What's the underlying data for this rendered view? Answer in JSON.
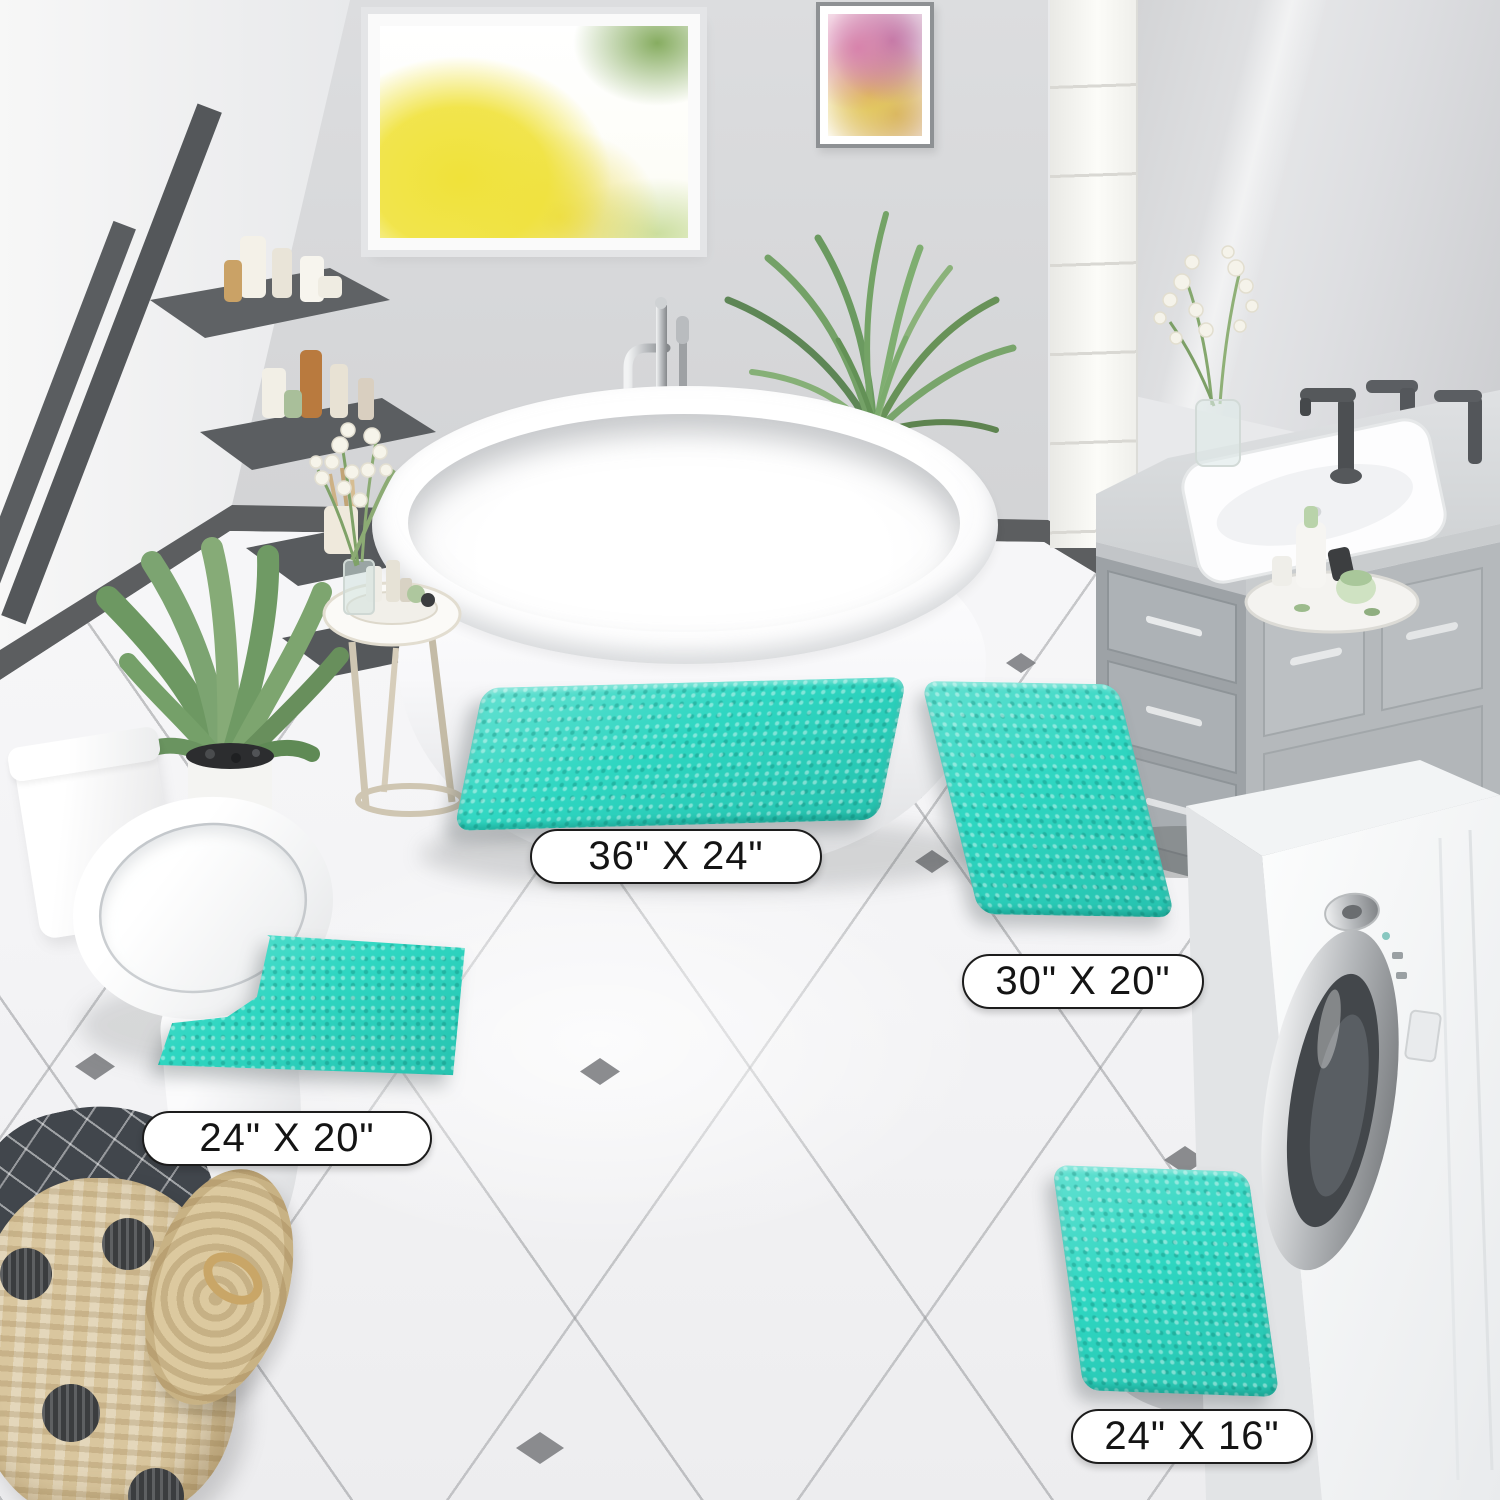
{
  "scene": {
    "type": "bathroom-product-photo",
    "subject": "4-piece turquoise chenille bath rug set shown on bathroom floor",
    "room_objects": [
      "window-with-yellow-trees",
      "wall-art",
      "ladder-shelf",
      "toilet",
      "potted-plant",
      "freestanding-bathtub",
      "tub-faucet",
      "palm-plant",
      "side-table",
      "gladiolus-flowers",
      "double-sink-vanity",
      "mirror",
      "tall-cabinet",
      "washing-machine",
      "wicker-laundry-basket"
    ]
  },
  "rug": {
    "color_name": "turquoise",
    "color_hex": "#2ed6c1"
  },
  "size_labels": [
    {
      "mat": "rectangle-large",
      "text": "36\" X 24\""
    },
    {
      "mat": "rectangle-medium",
      "text": "30\" X 20\""
    },
    {
      "mat": "contour-u-shape",
      "text": "24\" X 20\""
    },
    {
      "mat": "rectangle-small",
      "text": "24\" X 16\""
    }
  ],
  "palette": {
    "back_wall": "#d6d7d9",
    "left_wall": "#f4f4f4",
    "floor": "#f6f6f7",
    "grout": "#c8c9cb",
    "baseboard": "#5c5e60",
    "accent_diamond": "#7e8083",
    "vanity": "#a6abaf",
    "ladder": "#54575a",
    "basket": "#d9c69e"
  }
}
